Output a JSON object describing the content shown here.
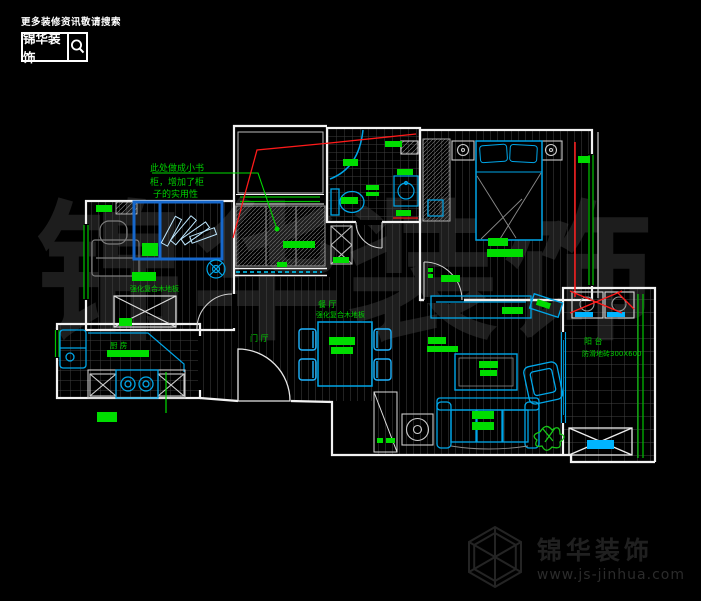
{
  "header": {
    "tagline": "更多装修资讯敬请搜索",
    "brand": "锦华装饰"
  },
  "watermark": {
    "text": "锦华装饰"
  },
  "footer": {
    "brand": "锦华装饰",
    "website": "www.js-jinhua.com"
  },
  "plan": {
    "note": {
      "line1": "此处做成小书",
      "line2": "柜，增加了柜",
      "line3": "子的实用性"
    },
    "rooms": {
      "dining": {
        "name": "餐 厅",
        "floor": "强化复合木地板"
      },
      "foyer": {
        "name": "门 厅"
      },
      "kitchen": {
        "name": "厨 房"
      },
      "study": {
        "floor": "强化复合木地板"
      },
      "balcony": {
        "name": "阳 台",
        "floor": "防滑地砖300X600"
      }
    },
    "colors": {
      "wall": "#f2f2f2",
      "furniture": "#00a6e8",
      "label": "#00dd00",
      "annotation": "#ff1a1a",
      "watermark": "#1d1d1d"
    }
  }
}
